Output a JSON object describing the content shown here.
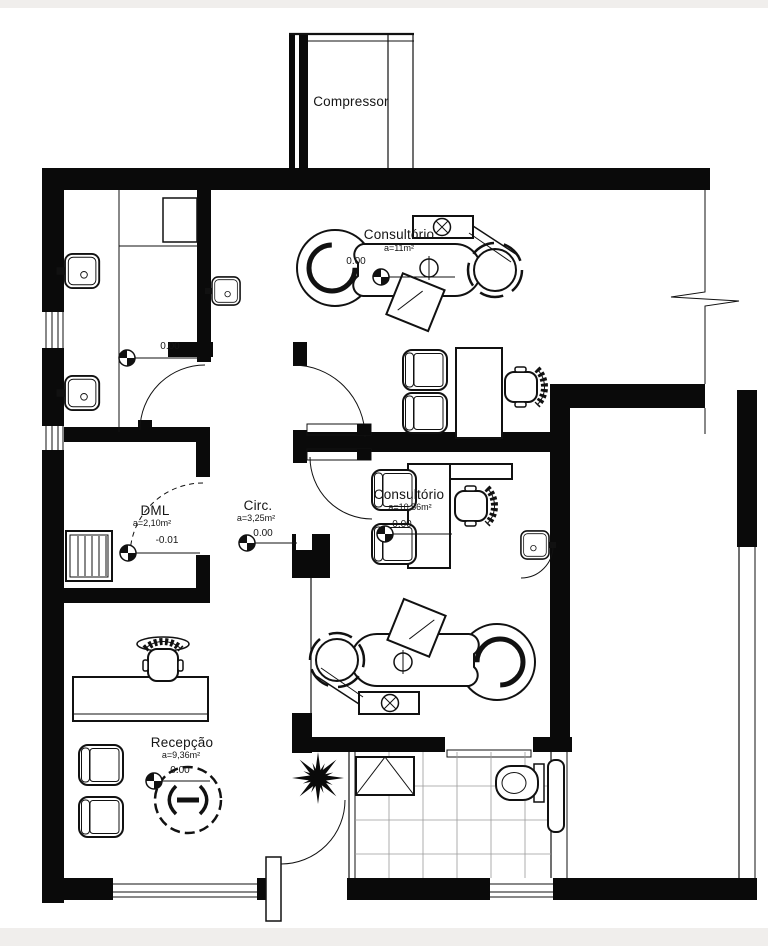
{
  "drawing": {
    "type": "architectural floor plan",
    "background_color": "#ffffff",
    "wall_color": "#0a0a0a",
    "line_color": "#111111"
  },
  "labels": {
    "compressor": {
      "name": "Compressor"
    },
    "consultorio1": {
      "name": "Consultório",
      "area": "a=11m²",
      "level": "0.00"
    },
    "consultorio2": {
      "name": "Consultório",
      "area": "a=10,56m²",
      "level": "0.00"
    },
    "circ": {
      "name": "Circ.",
      "area": "a=3,25m²",
      "level": "0.00"
    },
    "dml": {
      "name": "DML",
      "area": "a=2,10m²",
      "level": "-0.01"
    },
    "recepcao": {
      "name": "Recepção",
      "area": "a=9,36m²",
      "level": "0.00"
    },
    "hall": {
      "level": "0.00"
    }
  }
}
